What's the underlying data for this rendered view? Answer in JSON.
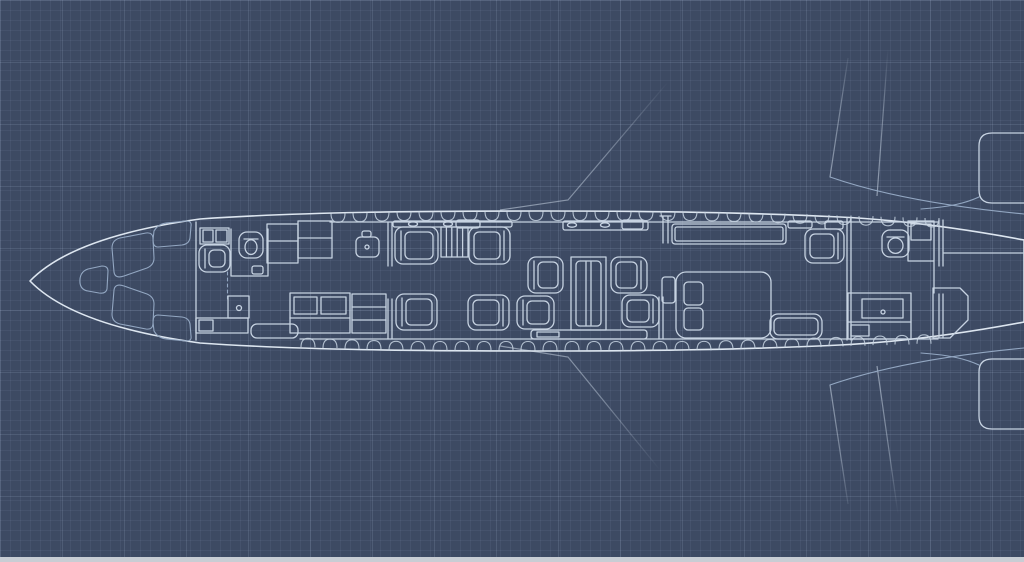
{
  "meta": {
    "description": "blueprint-floor-plan-of-private-jet-cabin-top-view",
    "canvas": {
      "width": 1024,
      "height": 562
    }
  },
  "palette": {
    "background": "#3d4a63",
    "grid_minor": "rgba(164,184,214,0.08)",
    "grid_major": "rgba(196,214,240,0.13)",
    "line": "#c7d3e2",
    "line_bright": "#dde6f0",
    "line_dim": "#93a7c2",
    "hull_fill": "rgba(205,220,240,0.05)",
    "furniture_shade": "rgba(16,24,40,0.22)",
    "furniture_shade2": "rgba(16,24,40,0.12)",
    "footer_strip": "#c8cdd4"
  },
  "windows": {
    "top": {
      "side": "top",
      "y": 211.5,
      "depth": 9,
      "flat": [
        400,
        700
      ],
      "slope_left": 0.03,
      "slope_right": 0.028,
      "half_width": 7,
      "centers": [
        338,
        360,
        382,
        404,
        426,
        448,
        470,
        492,
        514,
        536,
        558,
        580,
        602,
        624,
        646,
        668,
        690,
        712,
        734,
        756,
        778,
        800,
        822,
        844,
        866,
        888,
        910,
        932
      ]
    },
    "bottom": {
      "side": "bottom",
      "y": 350.5,
      "depth": 9,
      "flat": [
        400,
        700
      ],
      "slope_left": 0.035,
      "slope_right": 0.03,
      "half_width": 7,
      "centers": [
        308,
        330,
        352,
        374,
        396,
        418,
        440,
        462,
        484,
        506,
        528,
        550,
        572,
        594,
        616,
        638,
        660,
        682,
        704,
        726,
        748,
        770,
        792,
        814,
        836,
        858,
        880,
        902,
        924
      ]
    }
  },
  "furniture": [
    {
      "name": "avionics-cabinet",
      "type": "rect",
      "x": 200,
      "y": 228,
      "w": 29,
      "h": 16
    },
    {
      "name": "avionics-cell-a",
      "type": "rect",
      "x": 203,
      "y": 230,
      "w": 10,
      "h": 12,
      "fill": "shade"
    },
    {
      "name": "avionics-cell-b",
      "type": "rect",
      "x": 216,
      "y": 230,
      "w": 11,
      "h": 12
    },
    {
      "name": "cockpit-jump-seat",
      "type": "seat",
      "x": 199,
      "y": 245,
      "w": 31,
      "h": 27,
      "facing": "right"
    },
    {
      "name": "fwd-lav-walls",
      "type": "path",
      "d": "M231,229 L231,276 L268,276 L268,229"
    },
    {
      "name": "fwd-lav-toilet",
      "type": "toilet",
      "x": 239,
      "y": 232,
      "w": 24,
      "h": 26
    },
    {
      "name": "fwd-lav-door-handle",
      "type": "rect",
      "x": 252,
      "y": 266,
      "w": 11,
      "h": 8,
      "rx": 2
    },
    {
      "name": "fwd-lav-door-track",
      "type": "dline",
      "x1": 227.5,
      "y1": 272,
      "x2": 227.5,
      "y2": 301
    },
    {
      "name": "fwd-wardrobe",
      "type": "rect",
      "x": 228,
      "y": 296,
      "w": 21,
      "h": 22
    },
    {
      "name": "fwd-wardrobe-knob",
      "type": "circle",
      "cx": 239,
      "cy": 308,
      "r": 2.5
    },
    {
      "name": "entry-counter",
      "type": "rect",
      "x": 196,
      "y": 318,
      "w": 52,
      "h": 15
    },
    {
      "name": "entry-counter-drawer",
      "type": "rect",
      "x": 199,
      "y": 320,
      "w": 14,
      "h": 11
    },
    {
      "name": "entry-door-mat",
      "type": "rect",
      "x": 251,
      "y": 324,
      "w": 47,
      "h": 14,
      "rx": 6
    },
    {
      "name": "galley-upper-a",
      "type": "rect",
      "x": 267,
      "y": 224,
      "w": 31,
      "h": 39,
      "fill": "shade2"
    },
    {
      "name": "galley-upper-a-shelf",
      "type": "line",
      "x1": 267,
      "y1": 241,
      "x2": 298,
      "y2": 241
    },
    {
      "name": "galley-upper-b",
      "type": "rect",
      "x": 298,
      "y": 221,
      "w": 34,
      "h": 37,
      "fill": "shade2"
    },
    {
      "name": "galley-upper-b-shelf",
      "type": "line",
      "x1": 298,
      "y1": 238,
      "x2": 332,
      "y2": 238
    },
    {
      "name": "galley-sink",
      "type": "rect",
      "x": 356,
      "y": 237,
      "w": 23,
      "h": 20,
      "rx": 5
    },
    {
      "name": "galley-faucet",
      "type": "rect",
      "x": 362,
      "y": 231,
      "w": 9,
      "h": 6,
      "rx": 2
    },
    {
      "name": "galley-sink-drain",
      "type": "circle",
      "cx": 367,
      "cy": 247,
      "r": 2
    },
    {
      "name": "galley-lower",
      "type": "rect",
      "x": 290,
      "y": 293,
      "w": 60,
      "h": 40,
      "fill": "shade2"
    },
    {
      "name": "galley-lower-tray-a",
      "type": "rect",
      "x": 294,
      "y": 297,
      "w": 23,
      "h": 17
    },
    {
      "name": "galley-lower-tray-b",
      "type": "rect",
      "x": 321,
      "y": 297,
      "w": 25,
      "h": 17
    },
    {
      "name": "galley-lower-shelf",
      "type": "line",
      "x1": 290,
      "y1": 318,
      "x2": 350,
      "y2": 318
    },
    {
      "name": "fwd-closet",
      "type": "rect",
      "x": 352,
      "y": 294,
      "w": 34,
      "h": 39,
      "fill": "shade2"
    },
    {
      "name": "fwd-closet-shelf-a",
      "type": "line",
      "x1": 352,
      "y1": 307,
      "x2": 386,
      "y2": 307
    },
    {
      "name": "fwd-closet-shelf-b",
      "type": "line",
      "x1": 352,
      "y1": 320,
      "x2": 386,
      "y2": 320
    },
    {
      "name": "partition-fwd",
      "type": "dblv",
      "x": 388,
      "segs": [
        [
          222,
          266
        ],
        [
          299,
          339
        ]
      ]
    },
    {
      "name": "sidewall-rail-fwd",
      "type": "rect",
      "x": 393,
      "y": 221,
      "w": 119,
      "h": 6,
      "rx": 2
    },
    {
      "name": "rail-cup-a",
      "type": "ellipse",
      "cx": 413,
      "cy": 224,
      "rx": 4.5,
      "ry": 2.2
    },
    {
      "name": "rail-cup-b",
      "type": "ellipse",
      "cx": 448,
      "cy": 224,
      "rx": 4.5,
      "ry": 2.2
    },
    {
      "name": "rail-tray",
      "type": "rect",
      "x": 456,
      "y": 220,
      "w": 24,
      "h": 8,
      "rx": 3
    },
    {
      "name": "club-seat-1",
      "type": "seat",
      "x": 395,
      "y": 227,
      "w": 43,
      "h": 37,
      "facing": "right"
    },
    {
      "name": "club-cabinet",
      "type": "stripesv",
      "x": 441,
      "y": 227,
      "w": 27,
      "h": 30,
      "n": 4
    },
    {
      "name": "club-seat-2",
      "type": "seat",
      "x": 469,
      "y": 227,
      "w": 41,
      "h": 37,
      "facing": "left"
    },
    {
      "name": "club-seat-3",
      "type": "seat",
      "x": 396,
      "y": 294,
      "w": 41,
      "h": 36,
      "facing": "right"
    },
    {
      "name": "club-seat-4",
      "type": "seat",
      "x": 468,
      "y": 295,
      "w": 41,
      "h": 35,
      "facing": "left"
    },
    {
      "name": "conf-seat-tl",
      "type": "seat",
      "x": 528,
      "y": 257,
      "w": 35,
      "h": 36,
      "facing": "right"
    },
    {
      "name": "conf-seat-bl",
      "type": "seat",
      "x": 517,
      "y": 296,
      "w": 37,
      "h": 33,
      "facing": "right"
    },
    {
      "name": "conf-table",
      "type": "rect",
      "x": 571,
      "y": 257,
      "w": 35,
      "h": 73,
      "fill": "shade2"
    },
    {
      "name": "conf-table-top",
      "type": "rect",
      "x": 576,
      "y": 261,
      "w": 25,
      "h": 65,
      "rx": 4
    },
    {
      "name": "conf-table-pedestal-a",
      "type": "line",
      "x1": 586,
      "y1": 262,
      "x2": 586,
      "y2": 325
    },
    {
      "name": "conf-table-pedestal-b",
      "type": "line",
      "x1": 591,
      "y1": 262,
      "x2": 591,
      "y2": 325
    },
    {
      "name": "conf-seat-tr",
      "type": "seat",
      "x": 611,
      "y": 257,
      "w": 36,
      "h": 36,
      "facing": "left"
    },
    {
      "name": "conf-seat-br",
      "type": "seat",
      "x": 622,
      "y": 295,
      "w": 37,
      "h": 32,
      "facing": "left"
    },
    {
      "name": "conf-side-rail",
      "type": "rect",
      "x": 531,
      "y": 330,
      "w": 116,
      "h": 9,
      "rx": 3
    },
    {
      "name": "conf-side-rail-tray",
      "type": "rect",
      "x": 537,
      "y": 332,
      "w": 22,
      "h": 5
    },
    {
      "name": "sidewall-rail-mid",
      "type": "rect",
      "x": 563,
      "y": 221,
      "w": 85,
      "h": 9,
      "rx": 2
    },
    {
      "name": "rail-cup-c",
      "type": "ellipse",
      "cx": 572,
      "cy": 225,
      "rx": 4.5,
      "ry": 2.2
    },
    {
      "name": "rail-cup-d",
      "type": "ellipse",
      "cx": 605,
      "cy": 225,
      "rx": 4.5,
      "ry": 2.2
    },
    {
      "name": "rail-tray-b",
      "type": "rect",
      "x": 622,
      "y": 220,
      "w": 21,
      "h": 9,
      "rx": 2
    },
    {
      "name": "monitor-divider",
      "type": "path",
      "d": "M663,217 L663,243 M668,217 L668,243 M660,216 L671,216"
    },
    {
      "name": "side-table",
      "type": "rect",
      "x": 662,
      "y": 277,
      "w": 13,
      "h": 26,
      "rx": 3
    },
    {
      "name": "partition-mid",
      "type": "dblv",
      "x": 659,
      "segs": [
        [
          297,
          339
        ]
      ]
    },
    {
      "name": "credenza",
      "type": "rect",
      "x": 672,
      "y": 224,
      "w": 114,
      "h": 20,
      "rx": 3
    },
    {
      "name": "credenza-top",
      "type": "rect",
      "x": 675,
      "y": 227,
      "w": 108,
      "h": 14,
      "rx": 2
    },
    {
      "name": "stateroom-divan",
      "type": "rect",
      "x": 676,
      "y": 272,
      "w": 95,
      "h": 66,
      "rx": 10,
      "fill": "shade"
    },
    {
      "name": "divan-cushion-a",
      "type": "rect",
      "x": 684,
      "y": 282,
      "w": 19,
      "h": 23,
      "rx": 4
    },
    {
      "name": "divan-cushion-b",
      "type": "rect",
      "x": 684,
      "y": 308,
      "w": 19,
      "h": 22,
      "rx": 4
    },
    {
      "name": "sidewall-shelf-aft-a",
      "type": "rect",
      "x": 788,
      "y": 221,
      "w": 24,
      "h": 7,
      "rx": 2
    },
    {
      "name": "sidewall-shelf-aft-b",
      "type": "rect",
      "x": 825,
      "y": 221,
      "w": 18,
      "h": 8,
      "rx": 2
    },
    {
      "name": "aft-club-seat",
      "type": "seat",
      "x": 805,
      "y": 229,
      "w": 39,
      "h": 34,
      "facing": "left"
    },
    {
      "name": "aft-bench",
      "type": "rect",
      "x": 770,
      "y": 314,
      "w": 52,
      "h": 25,
      "rx": 8,
      "fill": "shade"
    },
    {
      "name": "aft-bench-cushion",
      "type": "rect",
      "x": 774,
      "y": 318,
      "w": 44,
      "h": 17,
      "rx": 5
    },
    {
      "name": "partition-aft",
      "type": "dblv",
      "x": 847,
      "segs": [
        [
          218,
          340
        ]
      ]
    },
    {
      "name": "aft-vanity",
      "type": "rect",
      "x": 848,
      "y": 293,
      "w": 63,
      "h": 46,
      "fill": "shade2"
    },
    {
      "name": "aft-vanity-basin",
      "type": "rect",
      "x": 862,
      "y": 299,
      "w": 41,
      "h": 19
    },
    {
      "name": "aft-vanity-drain",
      "type": "circle",
      "cx": 883,
      "cy": 312,
      "r": 2
    },
    {
      "name": "aft-vanity-shelf",
      "type": "line",
      "x1": 848,
      "y1": 322,
      "x2": 911,
      "y2": 322
    },
    {
      "name": "aft-vanity-drawer",
      "type": "rect",
      "x": 851,
      "y": 325,
      "w": 18,
      "h": 11
    },
    {
      "name": "aft-lav-toilet",
      "type": "toilet",
      "x": 882,
      "y": 230,
      "w": 27,
      "h": 27
    },
    {
      "name": "aft-lav-cabinet",
      "type": "rect",
      "x": 908,
      "y": 221,
      "w": 26,
      "h": 40,
      "fill": "shade2"
    },
    {
      "name": "aft-lav-cabinet-door",
      "type": "rect",
      "x": 911,
      "y": 224,
      "w": 20,
      "h": 16
    },
    {
      "name": "aft-lav-wall",
      "type": "line",
      "x1": 934,
      "y1": 261,
      "x2": 934,
      "y2": 293
    },
    {
      "name": "tail-bulkhead",
      "type": "dblv",
      "x": 939,
      "segs": [
        [
          220,
          266
        ],
        [
          294,
          338
        ]
      ]
    },
    {
      "name": "tail-shelf",
      "type": "line",
      "x1": 944,
      "y1": 253,
      "x2": 1024,
      "y2": 253
    },
    {
      "name": "tail-door",
      "type": "path",
      "d": "M933,288 L960,288 L968,296 L968,320 L950,338 L933,338 Z"
    }
  ]
}
